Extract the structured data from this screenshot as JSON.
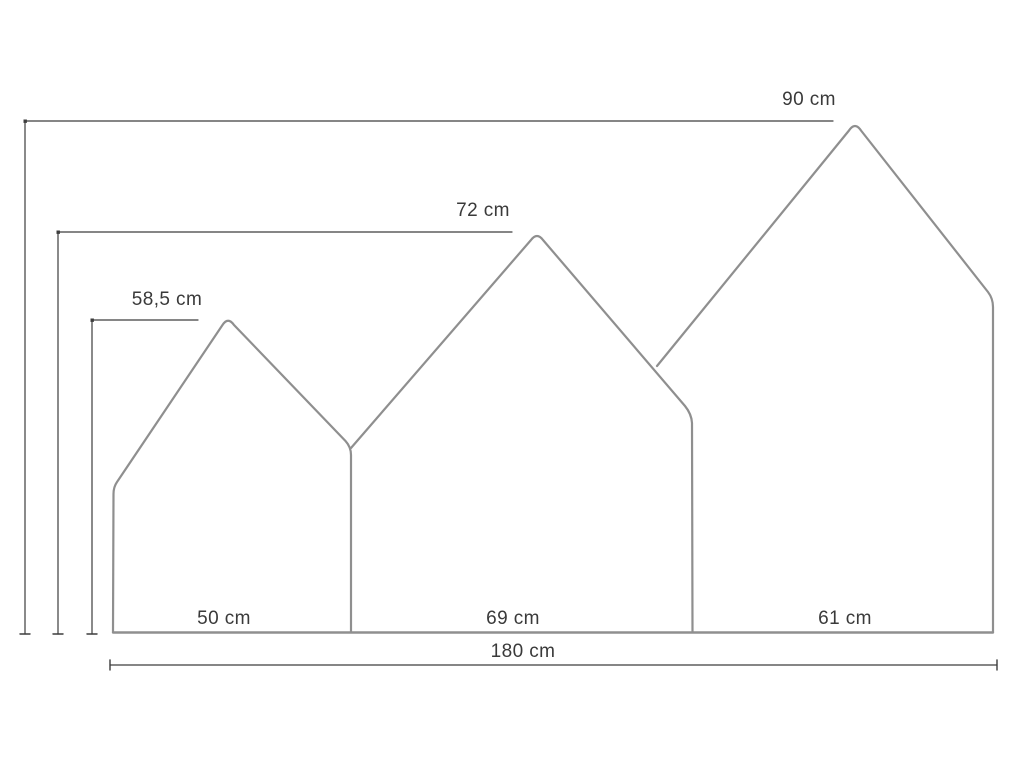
{
  "diagram": {
    "unit": "cm",
    "panels": [
      {
        "id": "left",
        "height_label": "58,5 cm",
        "width_label": "50 cm"
      },
      {
        "id": "middle",
        "height_label": "72 cm",
        "width_label": "69 cm"
      },
      {
        "id": "right",
        "height_label": "90 cm",
        "width_label": "61 cm"
      }
    ],
    "total_width_label": "180 cm",
    "colors": {
      "background": "#ffffff",
      "panel_outline": "#8f8f8f",
      "dimension_line": "#3d3d3d",
      "label_text": "#3a3a3a"
    }
  }
}
